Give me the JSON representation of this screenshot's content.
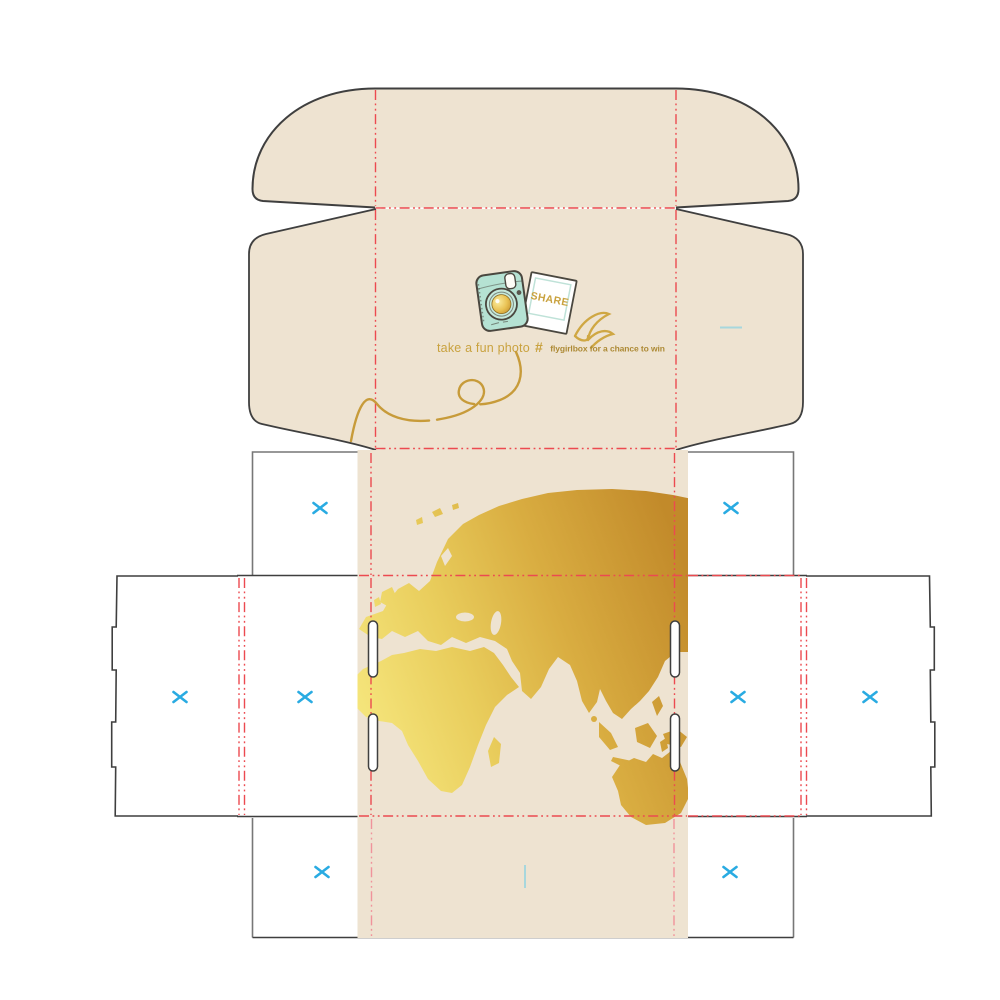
{
  "lid_artwork": {
    "photo_label": "SHARE",
    "caption_left": "take a fun photo",
    "hashtag": "#",
    "caption_right": "flygirlbox for a chance to win"
  },
  "colors": {
    "print_beige": "#eee3d1",
    "board_white": "#ffffff",
    "cut_line": "#3f3f3f",
    "cut_line_soft": "#777777",
    "fold_red": "#ec4a50",
    "fold_pink": "#f0939b",
    "reg_blue": "#29abe2",
    "reg_teal": "#a7d7dd",
    "gold_text": "#c9a23f",
    "gold_dark_text": "#ad8a35",
    "gold_1": "#f6e77e",
    "gold_2": "#e9cd5c",
    "gold_3": "#d9ad41",
    "gold_4": "#c28a2a",
    "camera_mint": "#b5e2d3",
    "camera_mint_light": "#c6e9dc",
    "camera_mint_border": "#bfe2d8",
    "outline_dark": "#4a473f"
  },
  "registration": {
    "x_marks": [
      {
        "x": 320,
        "y": 508
      },
      {
        "x": 731,
        "y": 508
      },
      {
        "x": 180,
        "y": 697
      },
      {
        "x": 305,
        "y": 697
      },
      {
        "x": 738,
        "y": 697
      },
      {
        "x": 870,
        "y": 697
      },
      {
        "x": 322,
        "y": 872
      },
      {
        "x": 730,
        "y": 872
      }
    ],
    "teal_dashes": [
      {
        "x1": 720,
        "y1": 327.5,
        "x2": 742,
        "y2": 327.5
      },
      {
        "x1": 525,
        "y1": 865,
        "x2": 525,
        "y2": 888
      }
    ]
  }
}
